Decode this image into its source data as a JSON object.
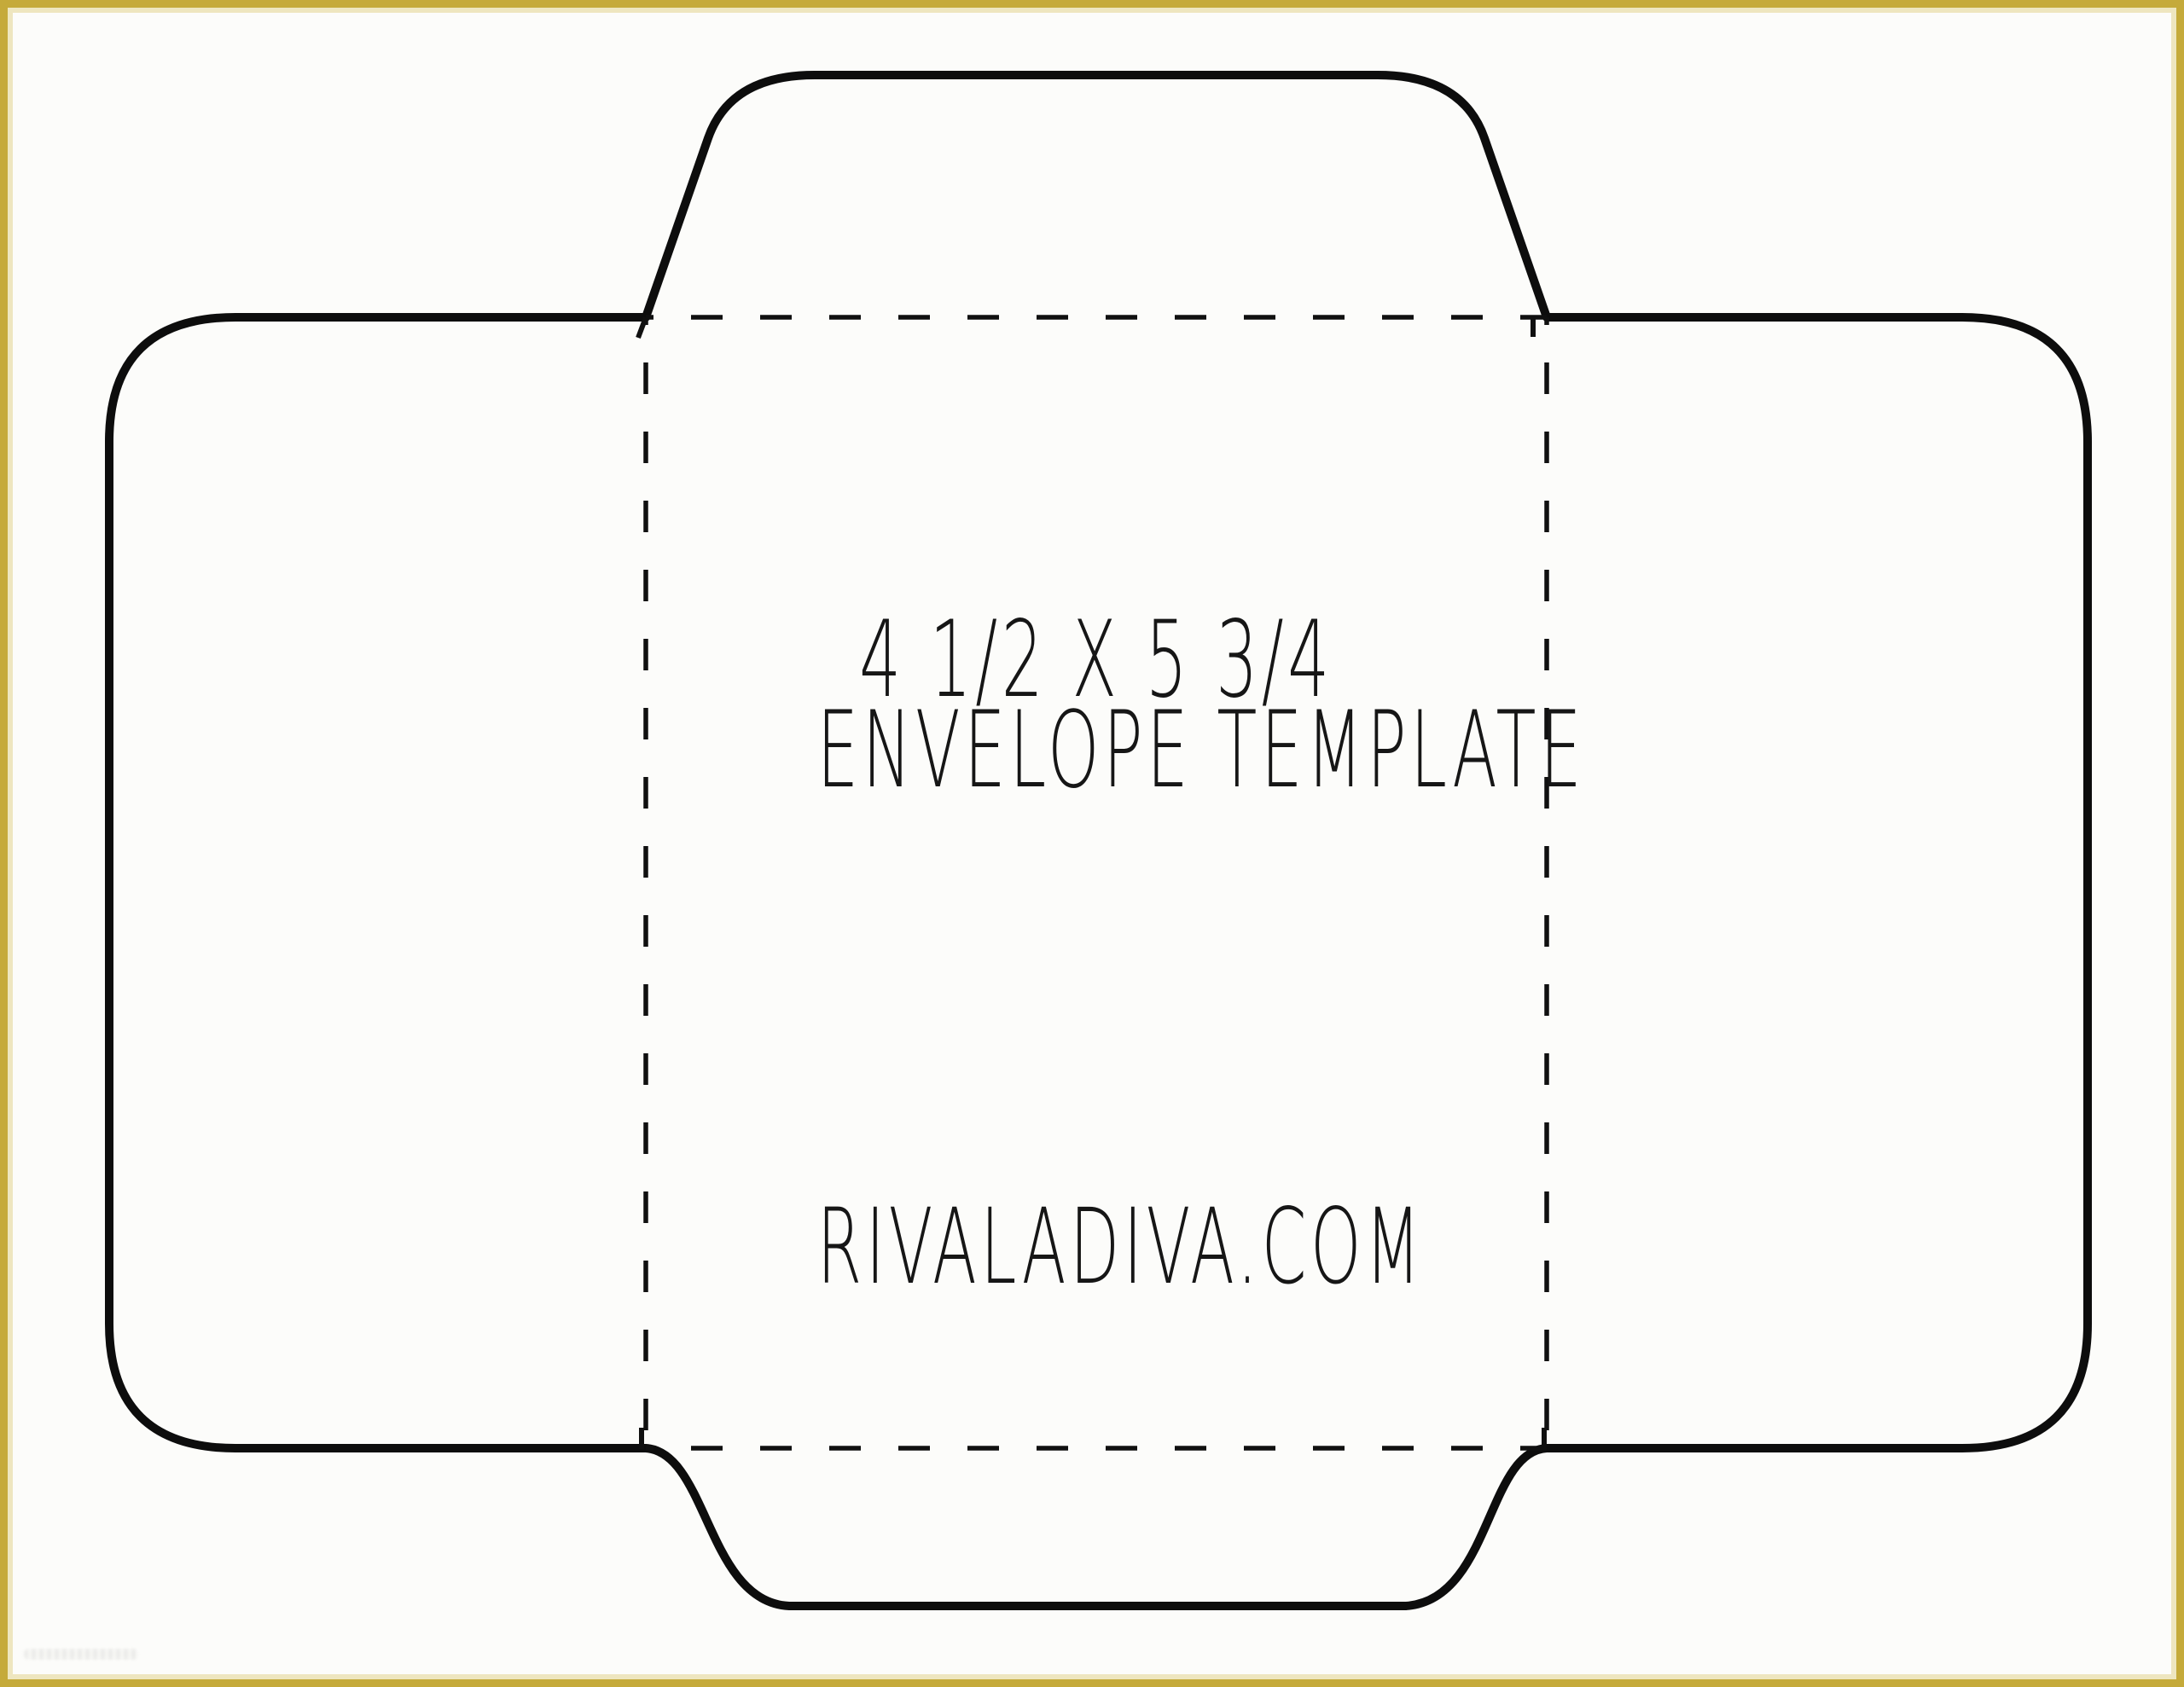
{
  "frame": {
    "border_color": "#c5aa3a",
    "background_color": "#fcfcfa"
  },
  "drawing": {
    "outline_color": "#0d0d0d",
    "fold_line_color": "#101010",
    "fold_line_style": "dashed"
  },
  "envelope": {
    "size_label": "4 1/2 X 5 3/4",
    "name_label": "ENVELOPE TEMPLATE",
    "website": "RIVALADIVA.COM"
  }
}
